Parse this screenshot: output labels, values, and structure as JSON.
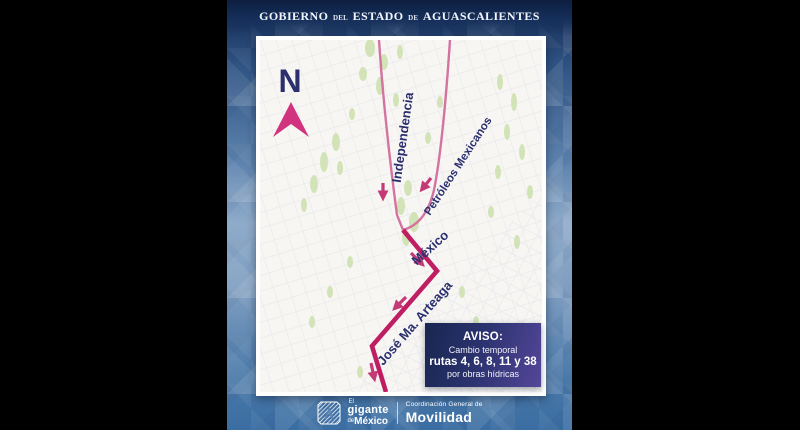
{
  "header": {
    "word1": "Gobierno",
    "word2": "del",
    "word3": "Estado",
    "word4": "de",
    "word5": "Aguascalientes"
  },
  "map": {
    "compass_label": "N",
    "streets": [
      {
        "name": "Independencia"
      },
      {
        "name": "Petróleos Mexicanos"
      },
      {
        "name": "México"
      },
      {
        "name": "José Ma. Arteaga"
      }
    ]
  },
  "notice": {
    "title": "AVISO:",
    "line1": "Cambio temporal",
    "line2": "rutas 4, 6, 8, 11 y 38",
    "line3": "por obras hídricas"
  },
  "footer": {
    "brand_el": "El",
    "brand_gigante": "gigante",
    "brand_de": "de",
    "brand_mexico": "México",
    "org_line1": "Coordinación General de",
    "org_line2": "Movilidad"
  },
  "colors": {
    "route_bold": "#c01e62",
    "route_thin": "#d4739f",
    "arrow_pink": "#c43a77",
    "label_navy": "#2b2f6e",
    "compass_pink": "#d1337f",
    "map_green": "#cfe2b1"
  }
}
